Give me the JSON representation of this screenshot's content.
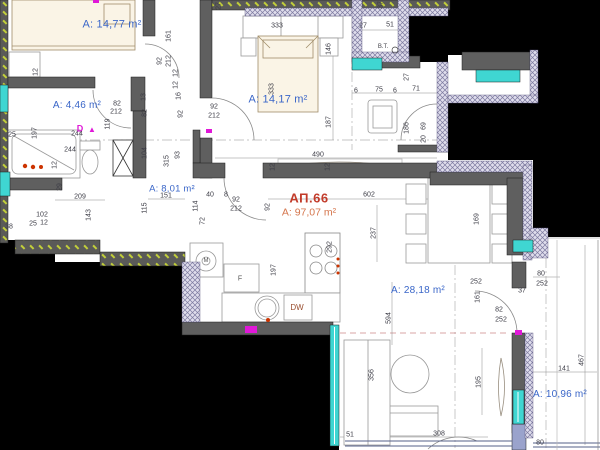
{
  "title": "Apartment floor plan",
  "apartment": {
    "id": "АП.66",
    "area": "А: 97,07 m²"
  },
  "colors": {
    "background": "#000000",
    "paper": "#ffffff",
    "wall": "#5f5f5f",
    "window": "#3fd6d2",
    "insulation_hatch": "#c2cf3a",
    "exterior_hatch": "#7d7aa0",
    "room_label": "#3a66c8",
    "apartment_number": "#c23b2a",
    "apartment_area": "#d5764d",
    "dimension_text": "#3c3c46",
    "marker": "#e018d8",
    "fixture_accent": "#cc3300"
  },
  "rooms": [
    {
      "name": "bedroom-1",
      "label": "А: 14,77 m²",
      "x": 112,
      "y": 25,
      "fs": 11
    },
    {
      "name": "bathroom",
      "label": "А: 4,46 m²",
      "x": 77,
      "y": 106,
      "fs": 10
    },
    {
      "name": "bedroom-2",
      "label": "А: 14,17 m²",
      "x": 278,
      "y": 100,
      "fs": 11
    },
    {
      "name": "hallway",
      "label": "А: 8,01 m²",
      "x": 172,
      "y": 189,
      "fs": 9.5
    },
    {
      "name": "living-room",
      "label": "А: 28,18 m²",
      "x": 418,
      "y": 291,
      "fs": 10
    },
    {
      "name": "terrace",
      "label": "А: 10,96 m²",
      "x": 560,
      "y": 395,
      "fs": 10
    }
  ],
  "annotations": [
    {
      "name": "vent-shaft-label",
      "t": "В.Т.",
      "x": 383,
      "y": 47,
      "c": "#44444c",
      "fs": 6,
      "b": false
    },
    {
      "name": "dishwasher-label",
      "t": "DW",
      "x": 297,
      "y": 308,
      "c": "#9a4f30",
      "fs": 8,
      "b": false
    },
    {
      "name": "door-marker-letter",
      "t": "D",
      "x": 80,
      "y": 129,
      "c": "#e018d8",
      "fs": 9,
      "b": true
    },
    {
      "name": "door-marker-triangle",
      "t": "▲",
      "x": 92,
      "y": 130,
      "c": "#e018d8",
      "fs": 8,
      "b": false
    },
    {
      "name": "washer-label",
      "t": "М",
      "x": 206,
      "y": 261,
      "c": "#555555",
      "fs": 6,
      "b": false
    },
    {
      "name": "fridge-label",
      "t": "F",
      "x": 240,
      "y": 279,
      "c": "#555555",
      "fs": 7,
      "b": false
    }
  ],
  "dimensions": [
    {
      "t": "12",
      "x": 36,
      "y": 72,
      "r": -90
    },
    {
      "t": "161",
      "x": 169,
      "y": 36,
      "r": -90
    },
    {
      "t": "92",
      "x": 160,
      "y": 61,
      "r": -90
    },
    {
      "t": "212",
      "x": 169,
      "y": 61,
      "r": -90
    },
    {
      "t": "12",
      "x": 176,
      "y": 73,
      "r": -90
    },
    {
      "t": "12",
      "x": 176,
      "y": 85,
      "r": -90
    },
    {
      "t": "16",
      "x": 179,
      "y": 96,
      "r": -90
    },
    {
      "t": "92",
      "x": 181,
      "y": 114,
      "r": -90
    },
    {
      "t": "13",
      "x": 144,
      "y": 97,
      "r": -90
    },
    {
      "t": "82",
      "x": 145,
      "y": 113,
      "r": -90
    },
    {
      "t": "82",
      "x": 117,
      "y": 104,
      "r": 0
    },
    {
      "t": "212",
      "x": 116,
      "y": 112,
      "r": 0
    },
    {
      "t": "119",
      "x": 108,
      "y": 124,
      "r": -90
    },
    {
      "t": "244",
      "x": 77,
      "y": 134,
      "r": 0
    },
    {
      "t": "244",
      "x": 70,
      "y": 150,
      "r": 0
    },
    {
      "t": "25",
      "x": 12,
      "y": 135,
      "r": 0
    },
    {
      "t": "197",
      "x": 35,
      "y": 133,
      "r": -90
    },
    {
      "t": "12",
      "x": 55,
      "y": 165,
      "r": -90
    },
    {
      "t": "104",
      "x": 145,
      "y": 153,
      "r": -90
    },
    {
      "t": "315",
      "x": 167,
      "y": 161,
      "r": -90
    },
    {
      "t": "93",
      "x": 178,
      "y": 155,
      "r": -90
    },
    {
      "t": "151",
      "x": 166,
      "y": 196,
      "r": 0
    },
    {
      "t": "115",
      "x": 145,
      "y": 208,
      "r": -90
    },
    {
      "t": "209",
      "x": 80,
      "y": 197,
      "r": 0
    },
    {
      "t": "143",
      "x": 89,
      "y": 215,
      "r": -90
    },
    {
      "t": "29",
      "x": 60,
      "y": 187,
      "r": -90
    },
    {
      "t": "102",
      "x": 42,
      "y": 215,
      "r": 0
    },
    {
      "t": "25",
      "x": 33,
      "y": 224,
      "r": 0
    },
    {
      "t": "12",
      "x": 44,
      "y": 223,
      "r": 0
    },
    {
      "t": "38",
      "x": 9,
      "y": 227,
      "r": 0
    },
    {
      "t": "27",
      "x": 219,
      "y": 6,
      "r": -90
    },
    {
      "t": "37",
      "x": 381,
      "y": 5,
      "r": -90
    },
    {
      "t": "333",
      "x": 277,
      "y": 26,
      "r": 0
    },
    {
      "t": "333",
      "x": 272,
      "y": 89,
      "r": -90
    },
    {
      "t": "146",
      "x": 329,
      "y": 49,
      "r": -90
    },
    {
      "t": "187",
      "x": 329,
      "y": 122,
      "r": -90
    },
    {
      "t": "92",
      "x": 214,
      "y": 107,
      "r": 0
    },
    {
      "t": "212",
      "x": 214,
      "y": 116,
      "r": 0
    },
    {
      "t": "27",
      "x": 363,
      "y": 26,
      "r": 0
    },
    {
      "t": "51",
      "x": 390,
      "y": 25,
      "r": 0
    },
    {
      "t": "6",
      "x": 356,
      "y": 91,
      "r": 0
    },
    {
      "t": "75",
      "x": 379,
      "y": 90,
      "r": 0
    },
    {
      "t": "6",
      "x": 395,
      "y": 91,
      "r": 0
    },
    {
      "t": "71",
      "x": 416,
      "y": 89,
      "r": 0
    },
    {
      "t": "27",
      "x": 407,
      "y": 77,
      "r": -90
    },
    {
      "t": "186",
      "x": 407,
      "y": 128,
      "r": -90
    },
    {
      "t": "69",
      "x": 424,
      "y": 126,
      "r": -90
    },
    {
      "t": "20",
      "x": 424,
      "y": 139,
      "r": -90
    },
    {
      "t": "490",
      "x": 318,
      "y": 155,
      "r": 0
    },
    {
      "t": "12",
      "x": 273,
      "y": 167,
      "r": -90
    },
    {
      "t": "12",
      "x": 328,
      "y": 167,
      "r": -90
    },
    {
      "t": "602",
      "x": 369,
      "y": 195,
      "r": 0
    },
    {
      "t": "237",
      "x": 374,
      "y": 233,
      "r": -90
    },
    {
      "t": "92",
      "x": 268,
      "y": 207,
      "r": -90
    },
    {
      "t": "40",
      "x": 210,
      "y": 195,
      "r": 0
    },
    {
      "t": "8",
      "x": 226,
      "y": 195,
      "r": 0
    },
    {
      "t": "92",
      "x": 236,
      "y": 200,
      "r": 0
    },
    {
      "t": "212",
      "x": 236,
      "y": 209,
      "r": 0
    },
    {
      "t": "114",
      "x": 196,
      "y": 206,
      "r": -90
    },
    {
      "t": "72",
      "x": 203,
      "y": 221,
      "r": -90
    },
    {
      "t": "197",
      "x": 274,
      "y": 270,
      "r": -90
    },
    {
      "t": "292",
      "x": 330,
      "y": 247,
      "r": -90
    },
    {
      "t": "594",
      "x": 389,
      "y": 318,
      "r": -90
    },
    {
      "t": "356",
      "x": 372,
      "y": 375,
      "r": -90
    },
    {
      "t": "51",
      "x": 350,
      "y": 435,
      "r": 0
    },
    {
      "t": "308",
      "x": 439,
      "y": 434,
      "r": 0
    },
    {
      "t": "80",
      "x": 540,
      "y": 443,
      "r": 0
    },
    {
      "t": "252",
      "x": 476,
      "y": 282,
      "r": 0
    },
    {
      "t": "37",
      "x": 522,
      "y": 291,
      "r": 0
    },
    {
      "t": "161",
      "x": 478,
      "y": 297,
      "r": -90
    },
    {
      "t": "82",
      "x": 499,
      "y": 310,
      "r": 0
    },
    {
      "t": "252",
      "x": 501,
      "y": 320,
      "r": 0
    },
    {
      "t": "195",
      "x": 479,
      "y": 382,
      "r": -90
    },
    {
      "t": "141",
      "x": 564,
      "y": 369,
      "r": 0
    },
    {
      "t": "467",
      "x": 582,
      "y": 360,
      "r": -90
    },
    {
      "t": "169",
      "x": 477,
      "y": 219,
      "r": -90
    },
    {
      "t": "80",
      "x": 541,
      "y": 274,
      "r": 0
    },
    {
      "t": "252",
      "x": 542,
      "y": 284,
      "r": 0
    }
  ]
}
